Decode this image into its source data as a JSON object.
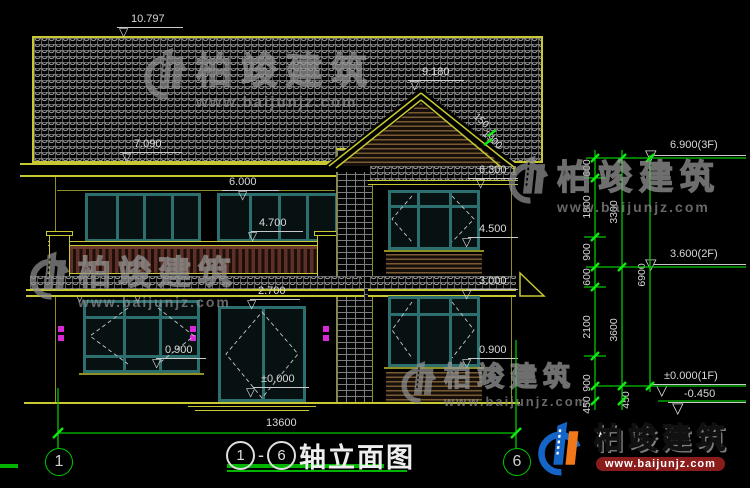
{
  "brand": {
    "name": "柏竣建筑",
    "site": "www.baijunjz.com"
  },
  "title": {
    "from": "1",
    "sep": "-",
    "to": "6",
    "text": "轴立面图"
  },
  "axis": {
    "left": "1",
    "right": "6"
  },
  "levels": {
    "ridge_left": "10.797",
    "eave_left": "7.090",
    "ridge_right": "9.180",
    "win_top_2f": "6.000",
    "eave_right": "6.300",
    "balcony_top": "4.700",
    "sill_2f_right": "4.500",
    "canopy_a": "2.950",
    "canopy_b": "3.000",
    "canopy_right": "3.000",
    "door_top": "2.700",
    "sill_1f_left": "0.900",
    "sill_1f_right": "0.900",
    "floor_zero": "±0.000",
    "overall_width": "13600"
  },
  "floors": {
    "f3": "6.900(3F)",
    "f2": "3.600(2F)",
    "f1": "±0.000(1F)",
    "grade": "-0.450"
  },
  "chains": {
    "c1": [
      "600",
      "1800",
      "900",
      "600",
      "2100",
      "900",
      "450"
    ],
    "c2": [
      "3300",
      "3600",
      "450"
    ],
    "total": "6900"
  },
  "slope": {
    "a": "150",
    "b": "1900"
  },
  "icons": {
    "level_triangle": "▽"
  }
}
